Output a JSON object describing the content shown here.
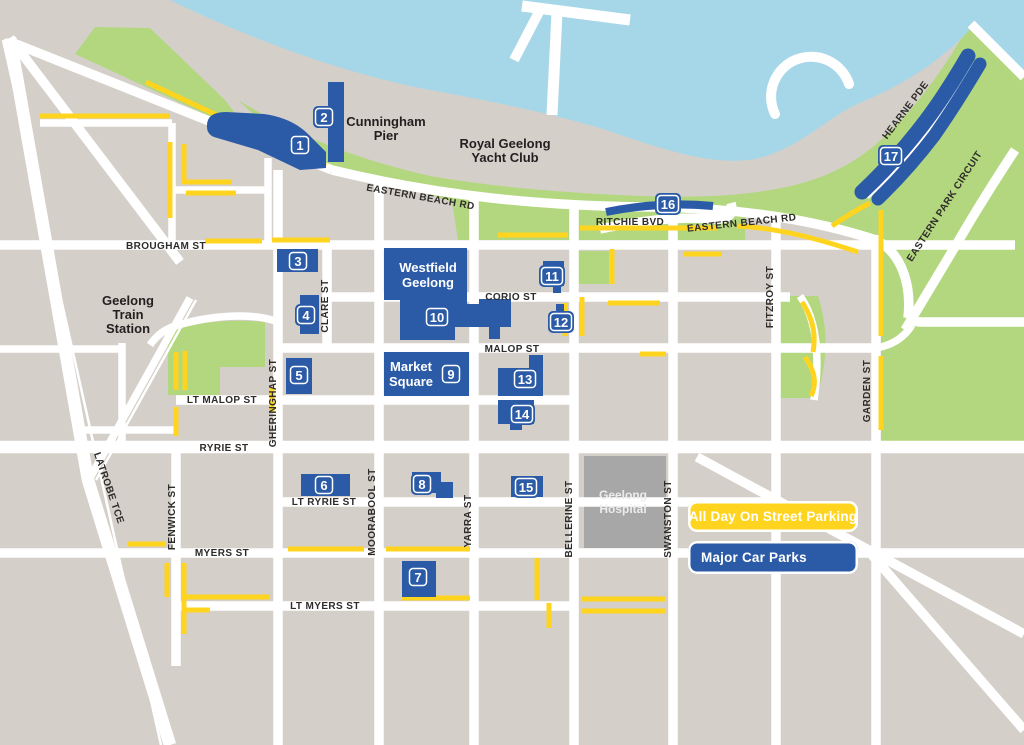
{
  "colors": {
    "water": "#A6D7E8",
    "land": "#D5CFC9",
    "park_green": "#B2D77E",
    "road": "#FFFFFF",
    "all_day_parking_yellow": "#FFD41F",
    "major_car_park_blue": "#2B5AA6",
    "hospital_gray": "#A7A7A7",
    "label_text": "#231F20"
  },
  "legend": {
    "items": [
      {
        "label": "All Day On Street Parking",
        "color": "#FFD41F"
      },
      {
        "label": "Major Car Parks",
        "color": "#2B5AA6"
      }
    ]
  },
  "streets": [
    {
      "label": "BROUGHAM ST"
    },
    {
      "label": "EASTERN BEACH RD"
    },
    {
      "label": "RITCHIE BVD"
    },
    {
      "label": "EASTERN BEACH RD"
    },
    {
      "label": "CORIO ST"
    },
    {
      "label": "MALOP ST"
    },
    {
      "label": "LT MALOP ST"
    },
    {
      "label": "RYRIE ST"
    },
    {
      "label": "LT RYRIE ST"
    },
    {
      "label": "MYERS ST"
    },
    {
      "label": "LT MYERS ST"
    },
    {
      "label": "LATROBE TCE"
    },
    {
      "label": "FENWICK ST"
    },
    {
      "label": "GHERINGHAP ST"
    },
    {
      "label": "CLARE ST"
    },
    {
      "label": "MOORABOOL ST"
    },
    {
      "label": "YARRA ST"
    },
    {
      "label": "BELLERINE ST"
    },
    {
      "label": "SWANSTON ST"
    },
    {
      "label": "FITZROY ST"
    },
    {
      "label": "GARDEN ST"
    },
    {
      "label": "EASTERN PARK CIRCUIT"
    },
    {
      "label": "HEARNE PDE"
    }
  ],
  "places": [
    {
      "name": "cunningham-pier",
      "lines": [
        "Cunningham",
        "Pier"
      ]
    },
    {
      "name": "royal-geelong-yacht-club",
      "lines": [
        "Royal Geelong",
        "Yacht Club"
      ]
    },
    {
      "name": "geelong-train-station",
      "lines": [
        "Geelong",
        "Train",
        "Station"
      ]
    },
    {
      "name": "westfield-geelong",
      "lines": [
        "Westfield",
        "Geelong"
      ]
    },
    {
      "name": "market-square",
      "lines": [
        "Market",
        "Square"
      ]
    },
    {
      "name": "geelong-hospital",
      "lines": [
        "Geelong",
        "Hospital"
      ]
    }
  ],
  "car_parks": [
    {
      "number": "1"
    },
    {
      "number": "2"
    },
    {
      "number": "3"
    },
    {
      "number": "4"
    },
    {
      "number": "5"
    },
    {
      "number": "6"
    },
    {
      "number": "7"
    },
    {
      "number": "8"
    },
    {
      "number": "9"
    },
    {
      "number": "10"
    },
    {
      "number": "11"
    },
    {
      "number": "12"
    },
    {
      "number": "13"
    },
    {
      "number": "14"
    },
    {
      "number": "15"
    },
    {
      "number": "16"
    },
    {
      "number": "17"
    }
  ]
}
